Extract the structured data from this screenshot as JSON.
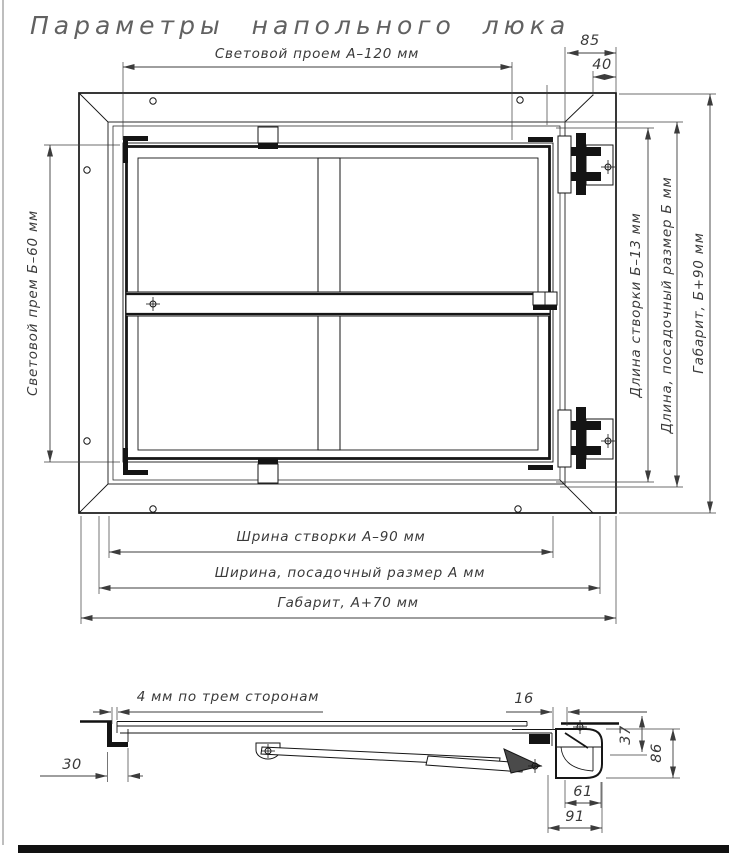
{
  "title": "Параметры напольного люка",
  "plan_dims": {
    "opening_width": "Световой проем А–120 мм",
    "hinge_offset": "85",
    "hinge_inset": "40",
    "opening_height": "Световой прем Б–60 мм",
    "leaf_length": "Длина створки Б–13 мм",
    "seat_length": "Длина, посадочный размер Б мм",
    "overall_length": "Габарит, Б+90 мм",
    "leaf_width": "Шрина створки А–90 мм",
    "seat_width": "Ширина, посадочный размер А мм",
    "overall_width": "Габарит, А+70 мм"
  },
  "section_dims": {
    "gap_note": "4 мм по трем сторонам",
    "frame_lip": "30",
    "edge_gap": "16",
    "recess_depth": "37",
    "box_height": "86",
    "box_inner_width": "61",
    "box_width": "91"
  }
}
